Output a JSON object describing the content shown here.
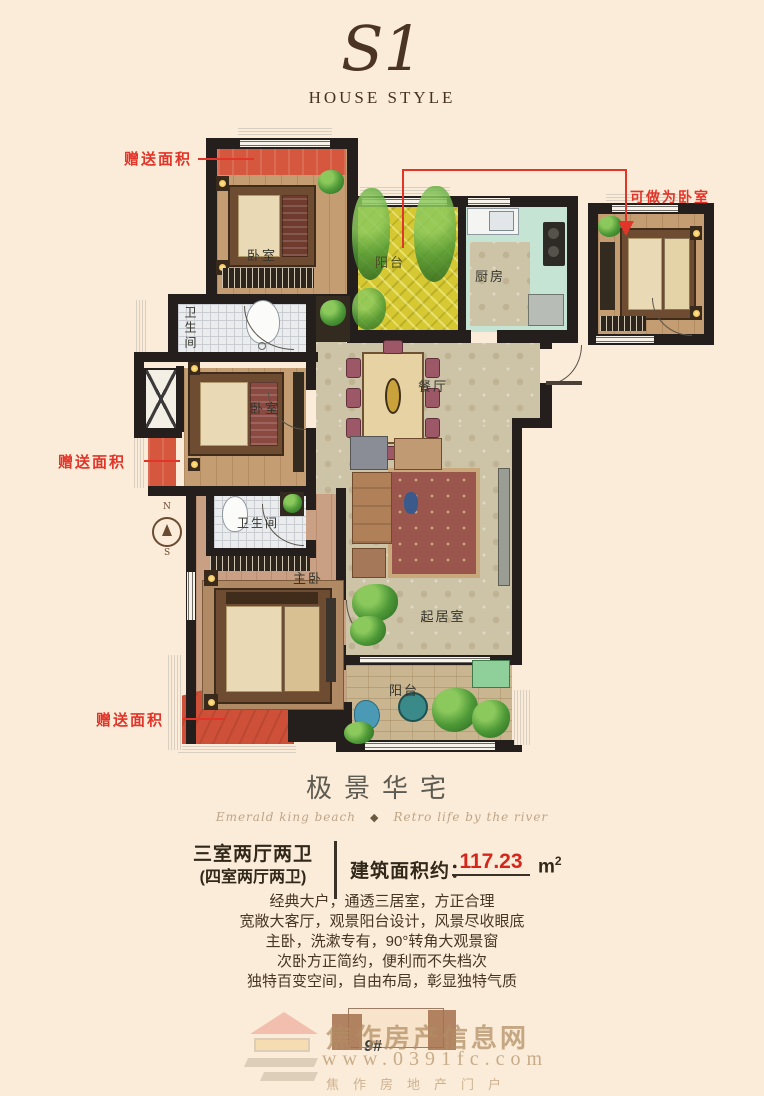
{
  "logo": {
    "monogram": "S1",
    "subtitle": "HOUSE STYLE"
  },
  "floorplan": {
    "rooms": [
      {
        "id": "bedroom-top",
        "label": "卧室"
      },
      {
        "id": "balcony-top",
        "label": "阳台"
      },
      {
        "id": "kitchen",
        "label": "厨房"
      },
      {
        "id": "bathroom-1",
        "label": "卫生间"
      },
      {
        "id": "dining",
        "label": "餐厅"
      },
      {
        "id": "bedroom-mid",
        "label": "卧室"
      },
      {
        "id": "bathroom-2",
        "label": "卫生间"
      },
      {
        "id": "master-bedroom",
        "label": "主卧"
      },
      {
        "id": "living",
        "label": "起居室"
      },
      {
        "id": "balcony-bottom",
        "label": "阳台"
      }
    ],
    "annotations": {
      "gift_area_1": "赠送面积",
      "gift_area_2": "赠送面积",
      "gift_area_3": "赠送面积",
      "convertible_room": "可做为卧室"
    },
    "compass": {
      "north": "N",
      "south": "S"
    },
    "colors": {
      "wall_black": "#241f1c",
      "annotation_red": "#e2352a",
      "gift_area_red": "#d5573d",
      "balcony_yellow": "#d5c832",
      "kitchen_green": "#c5e4d4",
      "background_cream": "#fbecd9"
    }
  },
  "info": {
    "title": "极景华宅",
    "tagline_left": "Emerald king beach",
    "tagline_right": "Retro life by the river",
    "ornament_glyph": "◆",
    "layout_main": "三室两厅两卫",
    "layout_alt": "(四室两厅两卫)",
    "area_label": "建筑面积约：",
    "area_value": "117.23",
    "area_unit_base": "m",
    "area_unit_sup": "2",
    "area_value_color": "#d6251b",
    "description_lines": [
      "经典大户，通透三居室，方正合理",
      "宽敞大客厅，观景阳台设计，风景尽收眼底",
      "主卧，洗漱专有，90°转角大观景窗",
      "次卧方正简约，便利而不失档次",
      "独特百变空间，自由布局，彰显独特气质"
    ]
  },
  "watermark": {
    "site_name": "焦作房产信息网",
    "site_url": "www.0391fc.com",
    "site_tagline": "焦作房地产门户",
    "building_no": "9#"
  }
}
